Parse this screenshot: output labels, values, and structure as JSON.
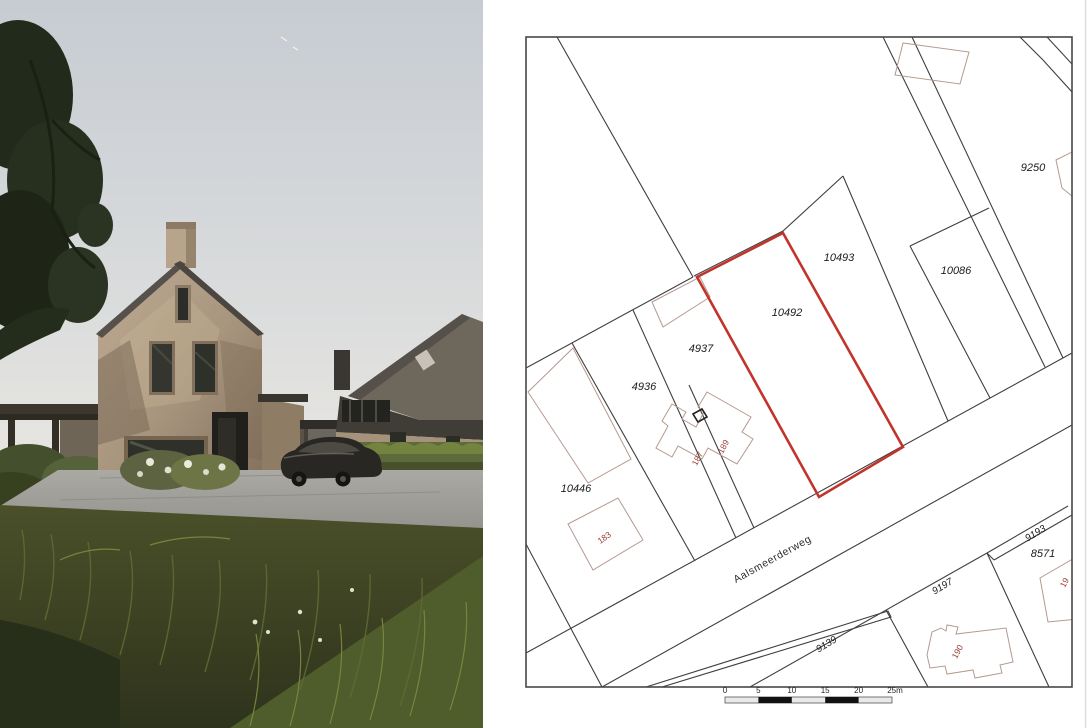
{
  "map": {
    "street_label": "Aalsmeerderweg",
    "parcel_labels": {
      "p9250": "9250",
      "p10493": "10493",
      "p10086": "10086",
      "p10492": "10492",
      "p4937": "4937",
      "p4936": "4936",
      "p10446": "10446",
      "p8571": "8571",
      "p9193": "9193",
      "p9197": "9197",
      "p9139": "9139"
    },
    "house_number_labels": {
      "h183": "183",
      "h187": "187",
      "h189": "189",
      "h190": "190",
      "h19x": "19"
    },
    "scale_ticks": {
      "t0": "0",
      "t5": "5",
      "t10": "10",
      "t15": "15",
      "t20": "20",
      "t25": "25m"
    },
    "colors": {
      "highlight": "#c2342b",
      "boundary": "#3f3f3f",
      "footprint": "#b49a90",
      "house_number": "#9c3b33"
    }
  }
}
